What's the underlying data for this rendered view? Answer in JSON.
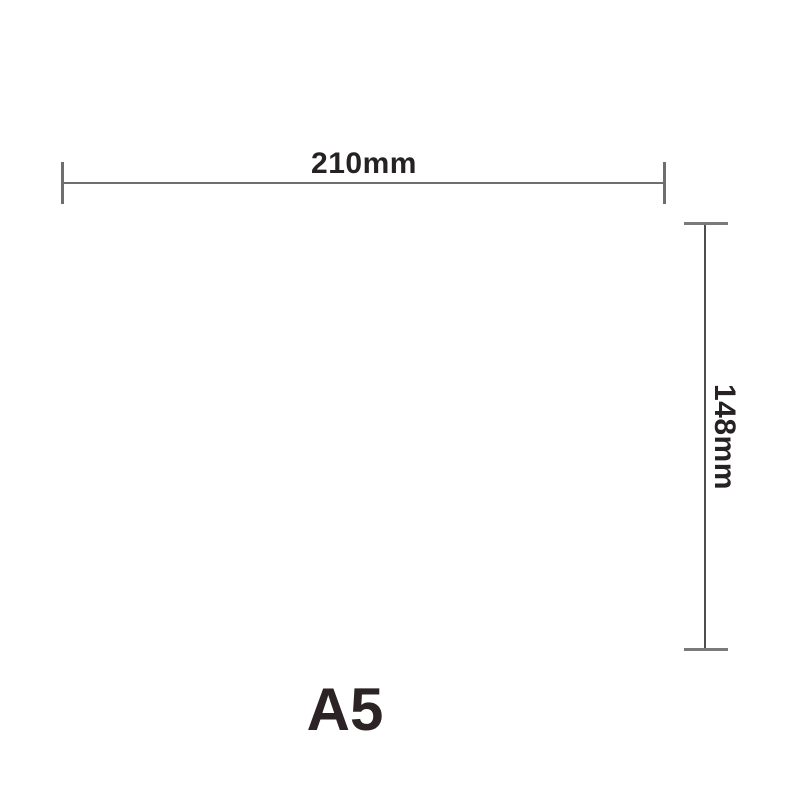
{
  "diagram": {
    "type": "dimension-drawing",
    "width_label": "210mm",
    "height_label": "148mm",
    "size_label": "A5"
  },
  "colors": {
    "background": "#ffffff",
    "dimension_line": "#6e6e6e",
    "vertical_line": "#4d4d4d",
    "label_text": "#262122"
  }
}
